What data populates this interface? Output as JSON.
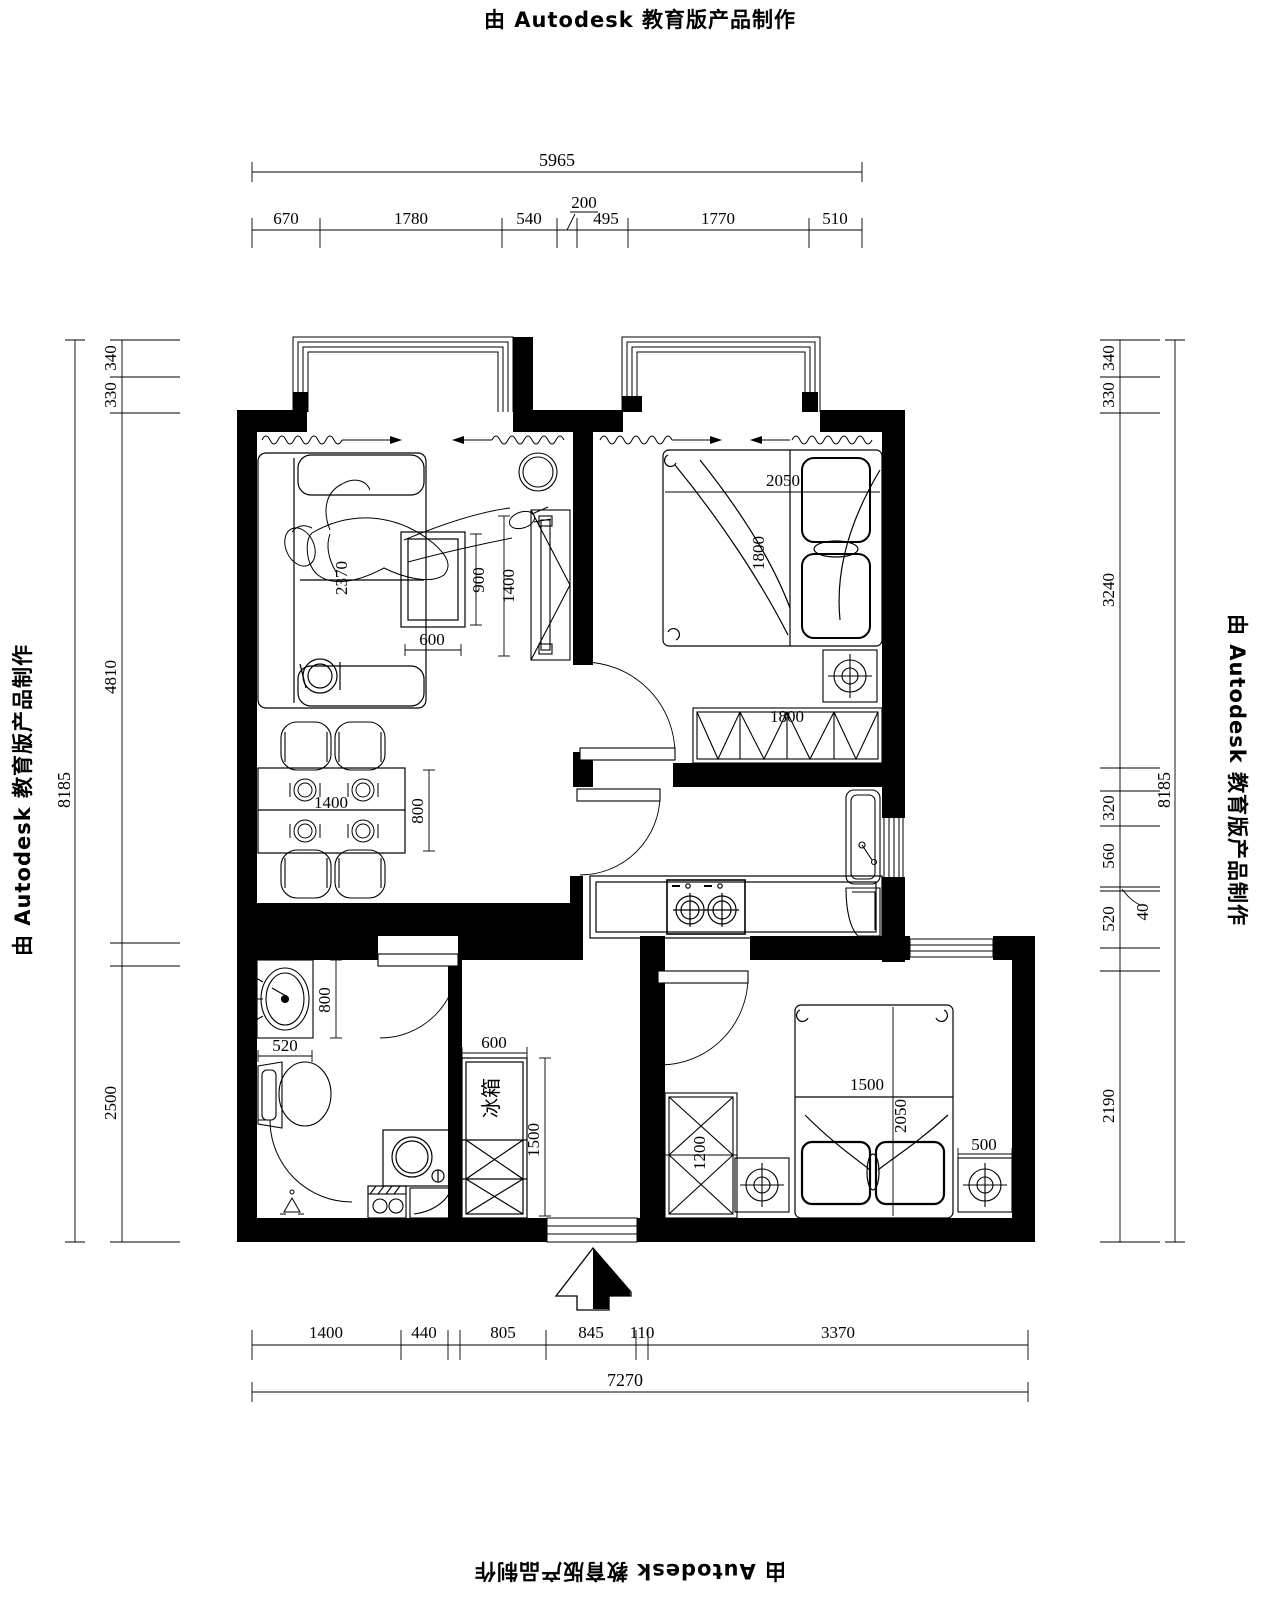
{
  "watermark": {
    "text": "由 Autodesk 教育版产品制作"
  },
  "dims": {
    "top_overall": "5965",
    "top_segments": [
      "670",
      "1780",
      "540",
      "200",
      "495",
      "1770",
      "510"
    ],
    "left_overall": "8185",
    "left_segments": [
      "340",
      "330",
      "4810",
      "2500"
    ],
    "right_overall": "8185",
    "right_segments": [
      "340",
      "330",
      "3240",
      "320",
      "560",
      "40",
      "520",
      "2190"
    ],
    "bottom_segments": [
      "1400",
      "440",
      "805",
      "845",
      "110",
      "3370"
    ],
    "bottom_overall": "7270"
  },
  "furniture_labels": {
    "sofa_length": "2370",
    "coffee_table_width": "600",
    "coffee_table_depth": "900",
    "tv_cabinet_length": "1400",
    "dining_table_length": "1400",
    "dining_table_depth": "800",
    "master_bed_length": "2050",
    "master_bed_width": "1800",
    "master_wardrobe_length": "1800",
    "vanity_depth": "800",
    "vanity_width": "520",
    "fridge_width": "600",
    "fridge_column_height": "1500",
    "fridge_text": "冰箱",
    "wardrobe2_width": "1200",
    "bed2_width": "1500",
    "bed2_length": "2050",
    "nightstand_width": "500"
  }
}
